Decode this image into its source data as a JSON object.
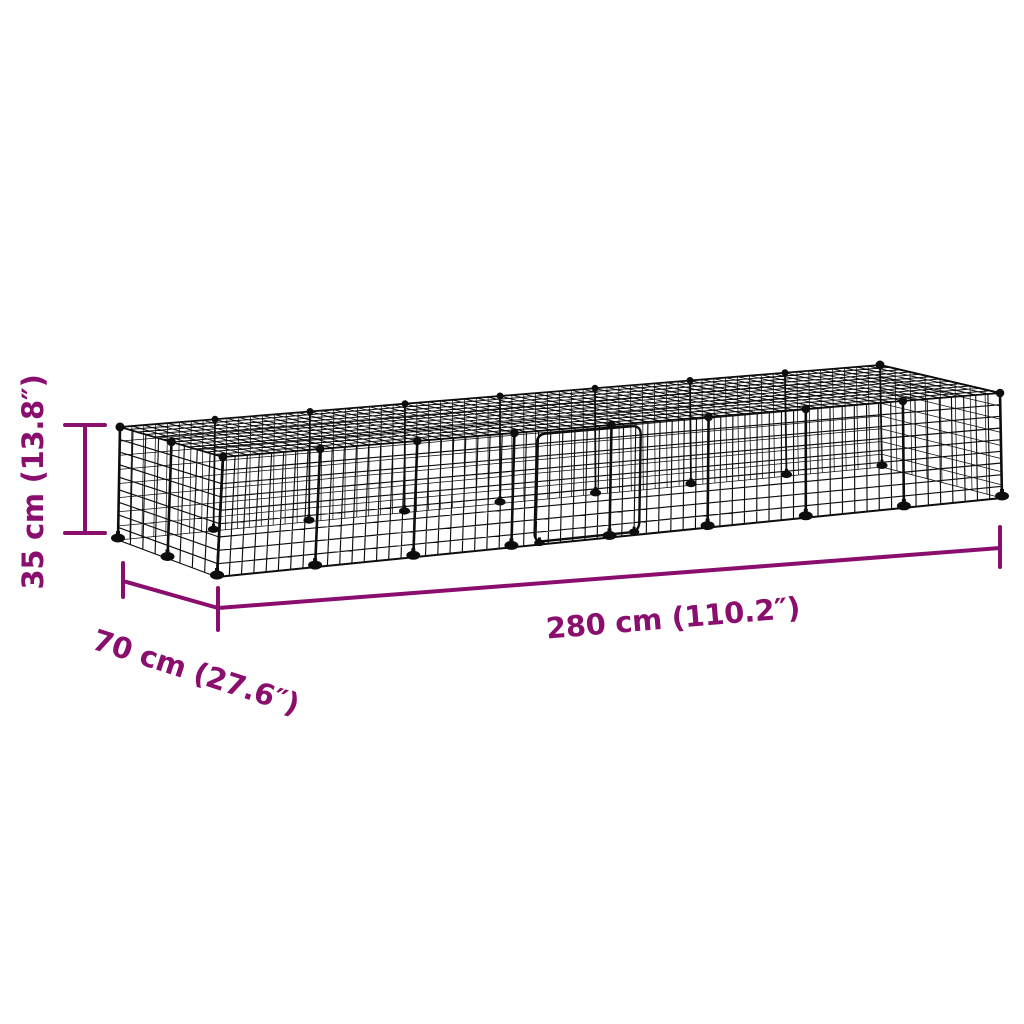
{
  "figure": {
    "kind": "product-dimension-diagram",
    "subject": "wire-grid-pet-enclosure"
  },
  "colors": {
    "dimension": "#8A0E6E",
    "cage": "#0d0d0d",
    "background": "#ffffff"
  },
  "dimensions": {
    "height": {
      "label": "35 cm (13.8″)"
    },
    "depth": {
      "label": "70 cm (27.6″)"
    },
    "length": {
      "label": "280 cm (110.2″)"
    }
  }
}
